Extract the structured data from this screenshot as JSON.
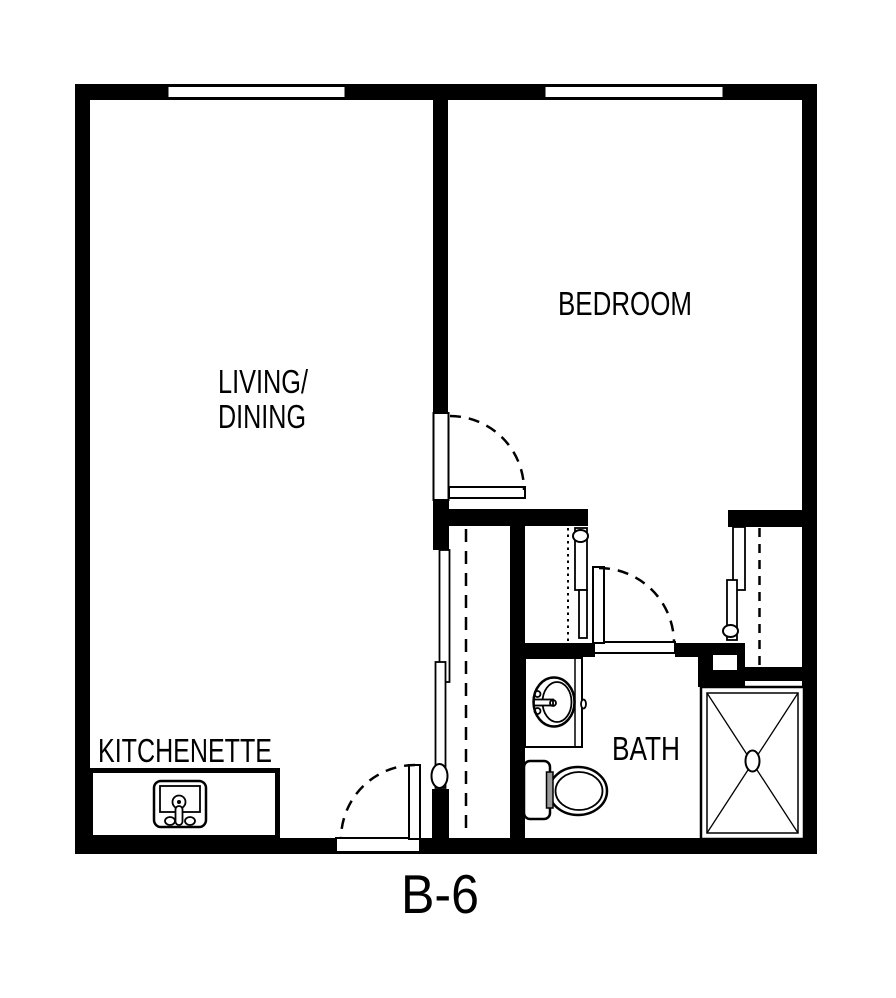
{
  "title": "Unit floor plan",
  "unit": {
    "label": "B-6"
  },
  "rooms": {
    "living_dining": {
      "line1": "LIVING/",
      "line2": "DINING"
    },
    "bedroom": {
      "label": "BEDROOM"
    },
    "kitchenette": {
      "label": "KITCHENETTE"
    },
    "bath": {
      "label": "BATH"
    }
  },
  "fixtures": {
    "kitchen_sink": "kitchen-sink",
    "bathroom_sink": "bathroom-vanity-sink",
    "toilet": "toilet",
    "shower": "shower-pan"
  },
  "colors": {
    "wall": "#000000",
    "background": "#ffffff",
    "toilet_flush_handle": "#999999"
  }
}
